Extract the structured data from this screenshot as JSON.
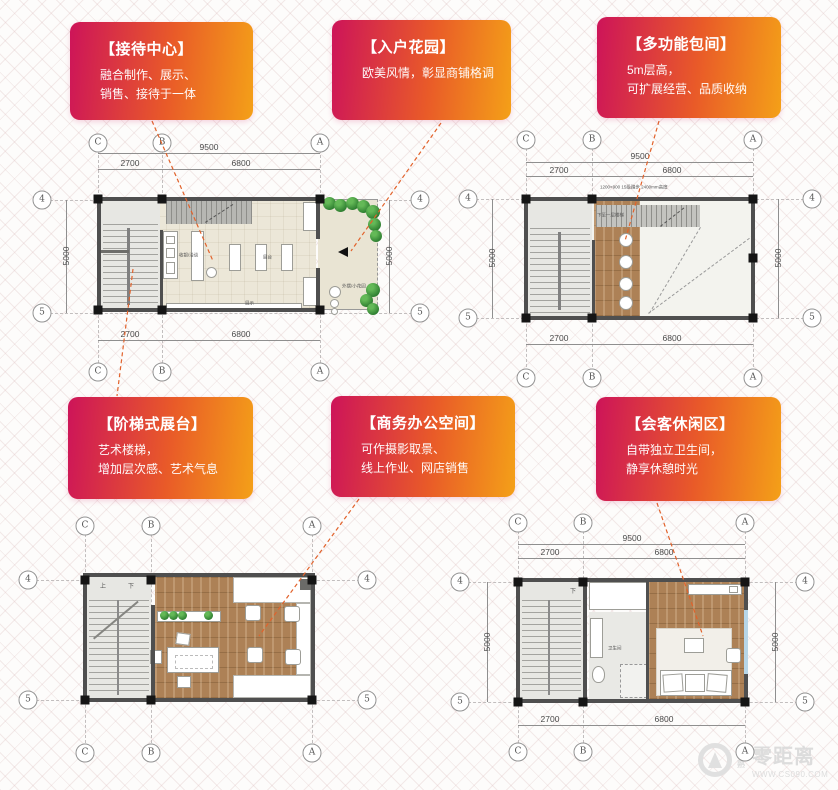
{
  "callouts": [
    {
      "title": "【接待中心】",
      "lines": [
        "融合制作、展示、",
        "销售、接待于一体"
      ]
    },
    {
      "title": "【入户花园】",
      "lines": [
        "欧美风情，彰显商铺格调"
      ]
    },
    {
      "title": "【多功能包间】",
      "lines": [
        "5m层高，",
        "可扩展经营、品质收纳"
      ]
    },
    {
      "title": "【阶梯式展台】",
      "lines": [
        "艺术楼梯，",
        "增加层次感、艺术气息"
      ]
    },
    {
      "title": "【商务办公空间】",
      "lines": [
        "可作摄影取景、",
        "线上作业、网店销售"
      ]
    },
    {
      "title": "【会客休闲区】",
      "lines": [
        "自带独立卫生间，",
        "静享休憩时光"
      ]
    }
  ],
  "colors": {
    "callout_from": "#cd1459",
    "callout_to": "#f4a018",
    "leader": "#e2622b",
    "wall": "#4f4f4f",
    "wood": "#ad8156",
    "tree": "#3f9e3f",
    "window": "#b7d6e8"
  },
  "plans": {
    "tl": {
      "cols": [
        "C",
        "B",
        "A"
      ],
      "rows": [
        "4",
        "5"
      ],
      "dims": {
        "total": "9500",
        "a": "2700",
        "b": "6800",
        "side": "5000"
      },
      "labels": {
        "cashier": "收银/洽谈",
        "counter": "展台",
        "display": "展示",
        "garden": "外摆/小花园"
      }
    },
    "tr": {
      "cols": [
        "C",
        "B",
        "A"
      ],
      "rows": [
        "4",
        "5"
      ],
      "dims": {
        "total": "9500",
        "a": "2700",
        "b": "6800",
        "side": "5000"
      },
      "labels": {
        "stair_note": "1200×900 15级踏步 2400mm高度",
        "down_stair": "下至一层楼梯"
      }
    },
    "bl": {
      "cols": [
        "C",
        "B",
        "A"
      ],
      "rows": [
        "4",
        "5"
      ],
      "labels": {
        "up": "上",
        "down": "下"
      }
    },
    "br": {
      "cols": [
        "C",
        "B",
        "A"
      ],
      "rows": [
        "4",
        "5"
      ],
      "dims": {
        "total": "9500",
        "a": "2700",
        "b": "6800",
        "side": "5000"
      },
      "labels": {
        "bath": "卫生间",
        "down": "下"
      }
    }
  },
  "watermark": {
    "prefix": "常熟",
    "name": "零距离",
    "site": "WWW.CS090.COM"
  }
}
